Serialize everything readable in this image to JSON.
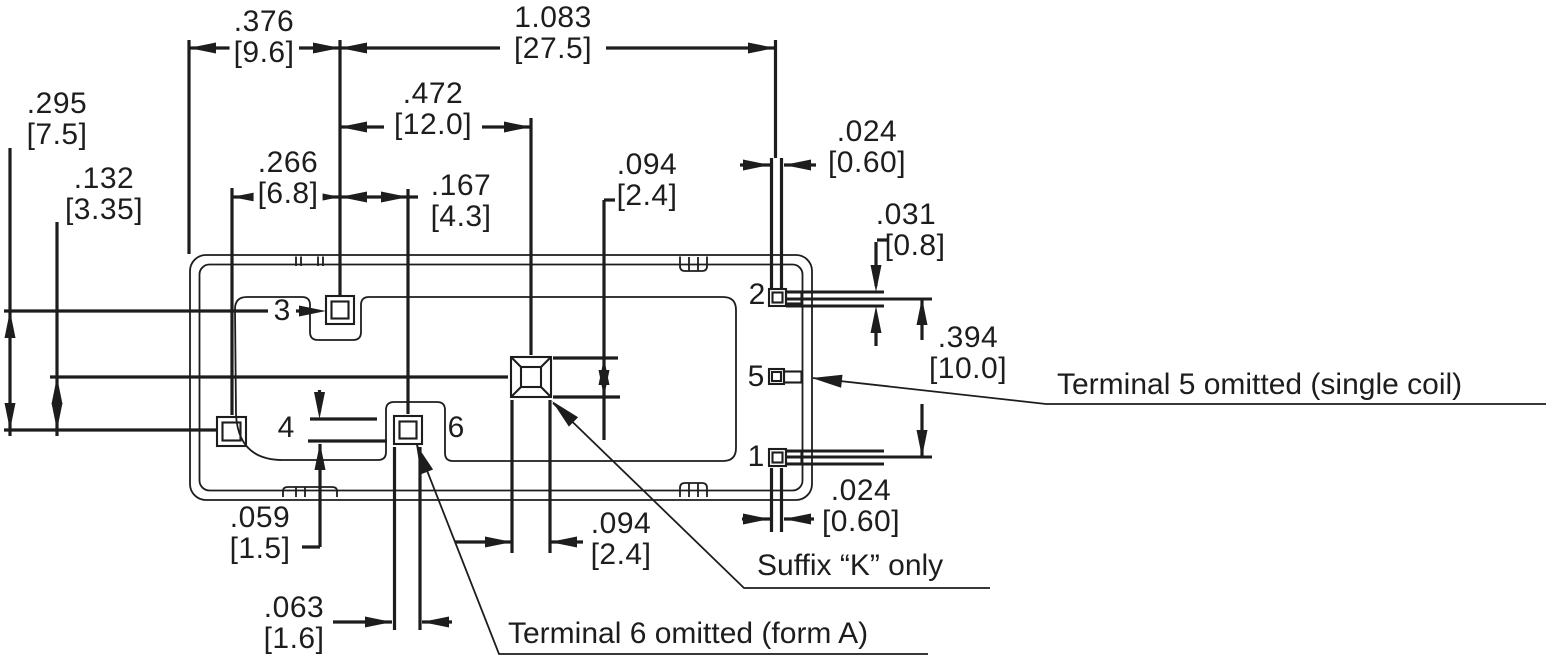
{
  "colors": {
    "ink": "#1d1d1d",
    "background": "#ffffff"
  },
  "drawing_title": "Relay PC-board footprint dimensional drawing",
  "dims": {
    "d376": {
      "in": ".376",
      "mm": "[9.6]"
    },
    "d1083": {
      "in": "1.083",
      "mm": "[27.5]"
    },
    "d472": {
      "in": ".472",
      "mm": "[12.0]"
    },
    "d266": {
      "in": ".266",
      "mm": "[6.8]"
    },
    "d167": {
      "in": ".167",
      "mm": "[4.3]"
    },
    "d094t": {
      "in": ".094",
      "mm": "[2.4]"
    },
    "d024t": {
      "in": ".024",
      "mm": "[0.60]"
    },
    "d031": {
      "in": ".031",
      "mm": "[0.8]"
    },
    "d394": {
      "in": ".394",
      "mm": "[10.0]"
    },
    "d295": {
      "in": ".295",
      "mm": "[7.5]"
    },
    "d132": {
      "in": ".132",
      "mm": "[3.35]"
    },
    "d059": {
      "in": ".059",
      "mm": "[1.5]"
    },
    "d063": {
      "in": ".063",
      "mm": "[1.6]"
    },
    "d094b": {
      "in": ".094",
      "mm": "[2.4]"
    },
    "d024b": {
      "in": ".024",
      "mm": "[0.60]"
    }
  },
  "terminals": {
    "t1": "1",
    "t2": "2",
    "t3": "3",
    "t4": "4",
    "t5": "5",
    "t6": "6"
  },
  "notes": {
    "terminal5": "Terminal 5 omitted (single coil)",
    "suffix_k": "Suffix “K” only",
    "terminal6": "Terminal 6 omitted (form A)"
  }
}
